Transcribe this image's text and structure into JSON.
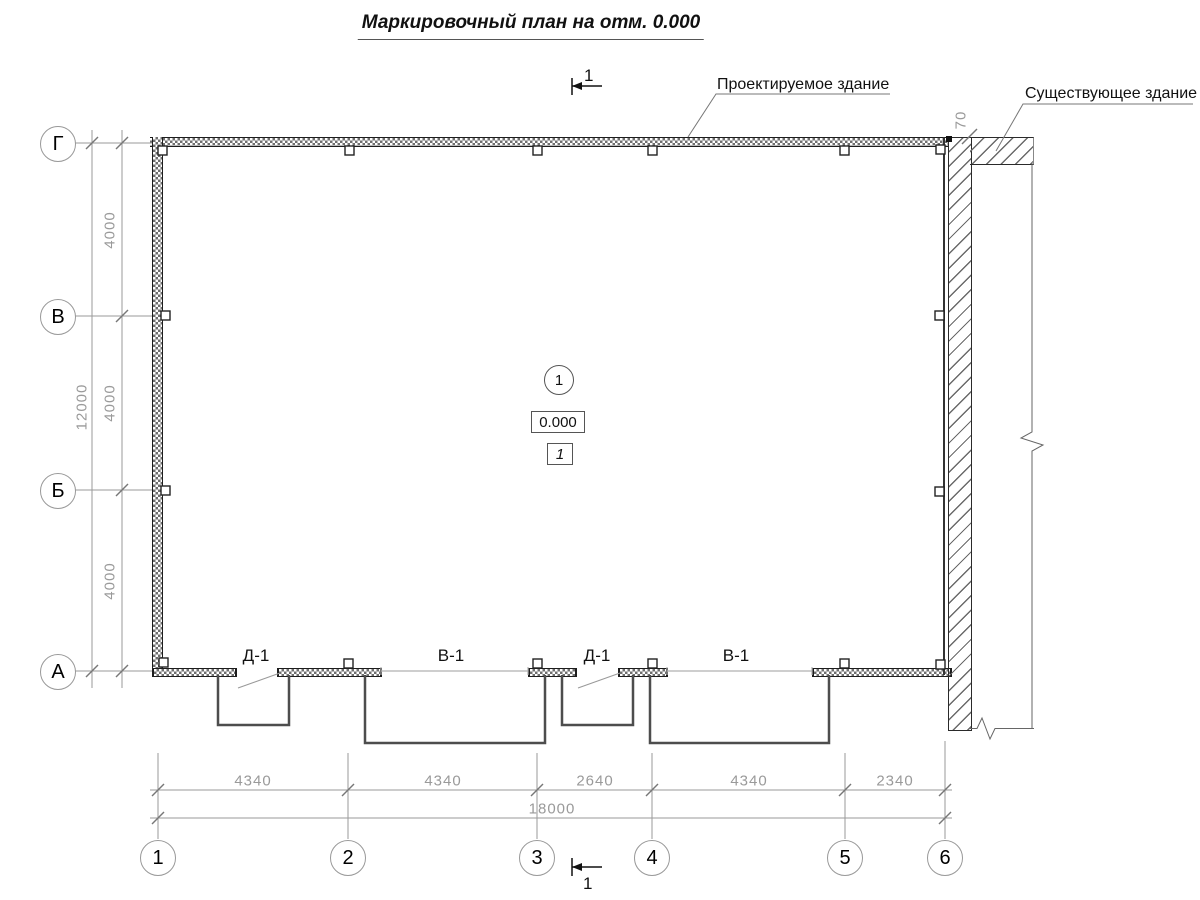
{
  "title": "Маркировочный план на отм. 0.000",
  "annotations": {
    "designed_building": "Проектируемое здание",
    "existing_building": "Существующее здание"
  },
  "section_mark": {
    "top": "1",
    "bottom": "1"
  },
  "axes": {
    "rows": [
      {
        "label": "Г"
      },
      {
        "label": "В"
      },
      {
        "label": "Б"
      },
      {
        "label": "А"
      }
    ],
    "cols": [
      {
        "label": "1"
      },
      {
        "label": "2"
      },
      {
        "label": "3"
      },
      {
        "label": "4"
      },
      {
        "label": "5"
      },
      {
        "label": "6"
      }
    ]
  },
  "dimensions": {
    "left_spans": [
      "4000",
      "4000",
      "4000"
    ],
    "left_total": "12000",
    "bottom_spans": [
      "4340",
      "4340",
      "2640",
      "4340",
      "2340"
    ],
    "bottom_total": "18000",
    "building_gap": "70"
  },
  "openings": [
    {
      "label": "Д-1"
    },
    {
      "label": "В-1"
    },
    {
      "label": "Д-1"
    },
    {
      "label": "В-1"
    }
  ],
  "center_markers": {
    "node_number": "1",
    "level_mark": "0.000",
    "room_number": "1"
  },
  "colors": {
    "wall_line": "#1d1d1d",
    "thin_line": "#9a9a9a",
    "dim_text": "#9a9a9a",
    "porch_line": "#4d4d4d"
  }
}
